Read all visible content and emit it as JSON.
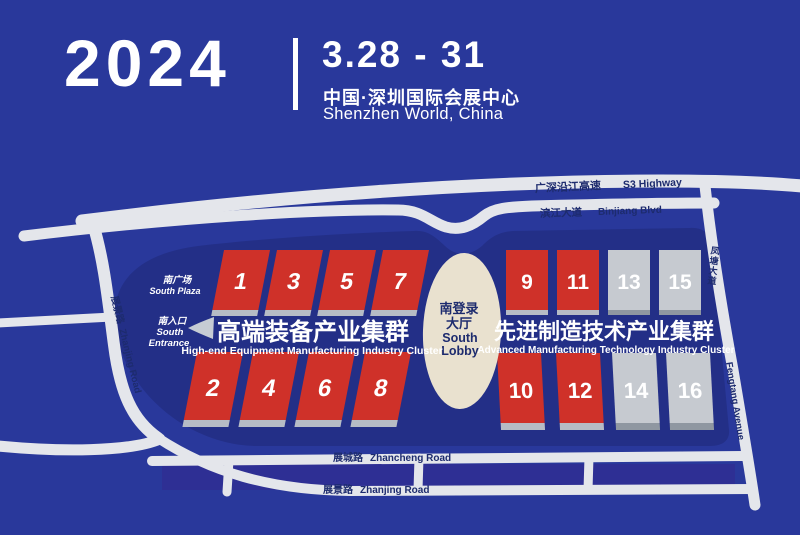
{
  "header": {
    "year": "2024",
    "dates": "3.28 - 31",
    "venue_cn": "中国·深圳国际会展中心",
    "venue_en": "Shenzhen World, China"
  },
  "map": {
    "roads": {
      "s3": {
        "cn": "广深沿江高速",
        "en": "S3 Highway"
      },
      "binjiang": {
        "cn": "滨江大道",
        "en": "Binjiang Blvd"
      },
      "zhanjing_west": {
        "cn": "展景路",
        "en": "Zhanjing Road"
      },
      "zhancheng": {
        "cn": "展城路",
        "en": "Zhancheng Road"
      },
      "zhanjing_south": {
        "cn": "展景路",
        "en": "Zhanjing Road"
      },
      "fengtang": {
        "cn": "凤塘大道",
        "en": "Fengtang Avenue"
      }
    },
    "south_plaza": {
      "cn": "南广场",
      "en": "South Plaza"
    },
    "south_entrance": {
      "cn": "南入口",
      "en1": "South",
      "en2": "Entrance"
    },
    "lobby": {
      "cn1": "南登录",
      "cn2": "大厅",
      "en1": "South",
      "en2": "Lobby"
    },
    "clusters": [
      {
        "cn": "高端装备产业集群",
        "en": "High-end Equipment Manufacturing Industry Cluster"
      },
      {
        "cn": "先进制造技术产业集群",
        "en": "Advanced Manufacturing Technology Industry Cluster"
      }
    ],
    "halls": [
      {
        "no": "1",
        "color": "red"
      },
      {
        "no": "3",
        "color": "red"
      },
      {
        "no": "5",
        "color": "red"
      },
      {
        "no": "7",
        "color": "red"
      },
      {
        "no": "2",
        "color": "red"
      },
      {
        "no": "4",
        "color": "red"
      },
      {
        "no": "6",
        "color": "red"
      },
      {
        "no": "8",
        "color": "red"
      },
      {
        "no": "9",
        "color": "red"
      },
      {
        "no": "11",
        "color": "red"
      },
      {
        "no": "13",
        "color": "gray"
      },
      {
        "no": "15",
        "color": "gray"
      },
      {
        "no": "10",
        "color": "red"
      },
      {
        "no": "12",
        "color": "red"
      },
      {
        "no": "14",
        "color": "gray"
      },
      {
        "no": "16",
        "color": "gray"
      }
    ]
  },
  "colors": {
    "background": "#29389b",
    "venue": "#232f87",
    "between_roads_strip": "#2e2f94",
    "road": "#e4e6eb",
    "hall_red": "#cf3129",
    "hall_gray": "#c6cad0",
    "lobby": "#e9e1cf",
    "road_label": "#1d2b6e",
    "text": "#ffffff"
  }
}
